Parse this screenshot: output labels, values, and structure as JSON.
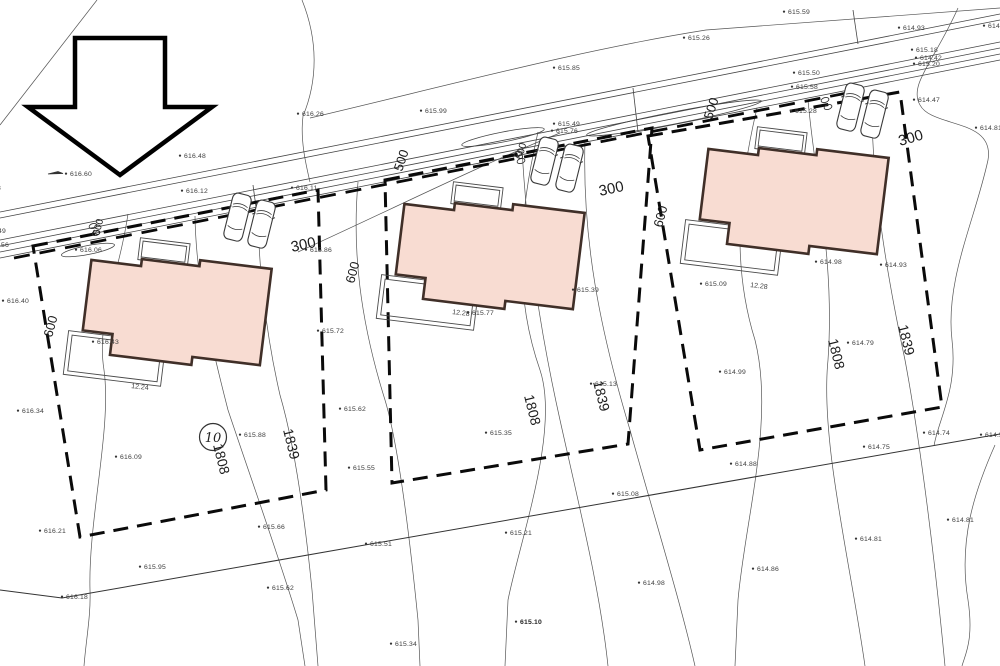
{
  "drawing": {
    "kind": "cadastral-site-plan",
    "plot_number_badge": "10",
    "colors": {
      "house_fill": "#f8dcd2",
      "house_stroke": "#402f28",
      "thin_line": "#4a4a4a",
      "boundary_dash": "#0a0a0a",
      "label_text": "#3d3d3d"
    },
    "elevation_points": [
      {
        "x": 70,
        "y": 176,
        "label": "616.60",
        "arrow": true
      },
      {
        "x": 184,
        "y": 158,
        "label": "616.48"
      },
      {
        "x": -21,
        "y": 190,
        "label": "616.38"
      },
      {
        "x": -16,
        "y": 233,
        "label": "616.49"
      },
      {
        "x": -13,
        "y": 247,
        "label": "616.56"
      },
      {
        "x": 7,
        "y": 303,
        "label": "616.40"
      },
      {
        "x": 22,
        "y": 413,
        "label": "616.34"
      },
      {
        "x": 44,
        "y": 533,
        "label": "616.21"
      },
      {
        "x": 120,
        "y": 459,
        "label": "616.09"
      },
      {
        "x": 80,
        "y": 252,
        "label": "616.06"
      },
      {
        "x": 97,
        "y": 344,
        "label": "616.43"
      },
      {
        "x": 244,
        "y": 437,
        "label": "615.88"
      },
      {
        "x": 144,
        "y": 569,
        "label": "615.95"
      },
      {
        "x": 66,
        "y": 599,
        "label": "616.18"
      },
      {
        "x": 263,
        "y": 529,
        "label": "615.66"
      },
      {
        "x": 272,
        "y": 590,
        "label": "615.62"
      },
      {
        "x": 395,
        "y": 646,
        "label": "615.34"
      },
      {
        "x": 520,
        "y": 624,
        "label": "615.10",
        "bold": true
      },
      {
        "x": 643,
        "y": 585,
        "label": "614.98"
      },
      {
        "x": 344,
        "y": 411,
        "label": "615.62"
      },
      {
        "x": 353,
        "y": 470,
        "label": "615.55"
      },
      {
        "x": 370,
        "y": 546,
        "label": "615.51"
      },
      {
        "x": 490,
        "y": 435,
        "label": "615.35"
      },
      {
        "x": 595,
        "y": 386,
        "label": "615.13"
      },
      {
        "x": 617,
        "y": 496,
        "label": "615.08"
      },
      {
        "x": 510,
        "y": 535,
        "label": "615.21"
      },
      {
        "x": 425,
        "y": 113,
        "label": "615.99"
      },
      {
        "x": 558,
        "y": 126,
        "label": "615.49"
      },
      {
        "x": 556,
        "y": 133,
        "label": "615.76"
      },
      {
        "x": 558,
        "y": 70,
        "label": "615.85"
      },
      {
        "x": 302,
        "y": 116,
        "label": "616.26"
      },
      {
        "x": 688,
        "y": 40,
        "label": "615.26"
      },
      {
        "x": 788,
        "y": 14,
        "label": "615.59"
      },
      {
        "x": 916,
        "y": 52,
        "label": "615.18"
      },
      {
        "x": 920,
        "y": 60,
        "label": "614.42"
      },
      {
        "x": 918,
        "y": 66,
        "label": "615.20"
      },
      {
        "x": 903,
        "y": 30,
        "label": "614.93"
      },
      {
        "x": 988,
        "y": 28,
        "label": "614.4"
      },
      {
        "x": 918,
        "y": 102,
        "label": "614.47"
      },
      {
        "x": 980,
        "y": 130,
        "label": "614.81"
      },
      {
        "x": 885,
        "y": 267,
        "label": "614.93"
      },
      {
        "x": 820,
        "y": 264,
        "label": "614.98"
      },
      {
        "x": 705,
        "y": 286,
        "label": "615.09"
      },
      {
        "x": 724,
        "y": 374,
        "label": "614.99"
      },
      {
        "x": 852,
        "y": 345,
        "label": "614.79"
      },
      {
        "x": 928,
        "y": 435,
        "label": "614.74"
      },
      {
        "x": 868,
        "y": 449,
        "label": "614.75"
      },
      {
        "x": 735,
        "y": 466,
        "label": "614.88"
      },
      {
        "x": 860,
        "y": 541,
        "label": "614.81"
      },
      {
        "x": 952,
        "y": 522,
        "label": "614.81"
      },
      {
        "x": 757,
        "y": 571,
        "label": "614.86"
      },
      {
        "x": 985,
        "y": 437,
        "label": "614.5"
      },
      {
        "x": 310,
        "y": 252,
        "label": "615.86"
      },
      {
        "x": 322,
        "y": 333,
        "label": "615.72"
      },
      {
        "x": 472,
        "y": 315,
        "label": "615.77"
      },
      {
        "x": 577,
        "y": 292,
        "label": "615.39"
      },
      {
        "x": 796,
        "y": 89,
        "label": "615.58"
      },
      {
        "x": 798,
        "y": 75,
        "label": "615.50"
      },
      {
        "x": 186,
        "y": 193,
        "label": "616.12"
      },
      {
        "x": 296,
        "y": 190,
        "label": "616.11"
      },
      {
        "x": 795,
        "y": 113,
        "label": "615.28"
      }
    ],
    "rotated_labels": [
      {
        "label": "300",
        "x": 292,
        "y": 252,
        "rot": -12,
        "size": 15
      },
      {
        "label": "300",
        "x": 600,
        "y": 196,
        "rot": -12,
        "size": 15
      },
      {
        "label": "300",
        "x": 900,
        "y": 146,
        "rot": -16,
        "size": 15
      },
      {
        "label": "600",
        "x": 52,
        "y": 338,
        "rot": -75,
        "size": 13
      },
      {
        "label": "600",
        "x": 354,
        "y": 284,
        "rot": -75,
        "size": 13
      },
      {
        "label": "600",
        "x": 662,
        "y": 228,
        "rot": -75,
        "size": 13
      },
      {
        "label": "600",
        "x": 522,
        "y": 160,
        "rot": -75,
        "size": 10
      },
      {
        "label": "600",
        "x": 99,
        "y": 236,
        "rot": -75,
        "size": 10
      },
      {
        "label": "500",
        "x": 402,
        "y": 172,
        "rot": -72,
        "size": 13
      },
      {
        "label": "500",
        "x": 712,
        "y": 120,
        "rot": -72,
        "size": 13
      },
      {
        "label": "1808",
        "x": 213,
        "y": 445,
        "rot": 76,
        "size": 14
      },
      {
        "label": "1839",
        "x": 283,
        "y": 430,
        "rot": 76,
        "size": 14
      },
      {
        "label": "1808",
        "x": 524,
        "y": 396,
        "rot": 76,
        "size": 14
      },
      {
        "label": "1839",
        "x": 593,
        "y": 382,
        "rot": 76,
        "size": 14
      },
      {
        "label": "1808",
        "x": 828,
        "y": 340,
        "rot": 76,
        "size": 14
      },
      {
        "label": "1839",
        "x": 898,
        "y": 326,
        "rot": 76,
        "size": 14
      }
    ],
    "dimension_labels": [
      {
        "label": "12.24",
        "x": 131,
        "y": 388,
        "rot": 7
      },
      {
        "label": "12.28",
        "x": 452,
        "y": 314,
        "rot": 7
      },
      {
        "label": "12.28",
        "x": 750,
        "y": 287,
        "rot": 7
      }
    ],
    "houses": [
      {
        "x": 93,
        "y": 247
      },
      {
        "x": 406,
        "y": 191
      },
      {
        "x": 710,
        "y": 136
      }
    ],
    "cars": [
      {
        "x": 234,
        "y": 192
      },
      {
        "x": 258,
        "y": 199
      },
      {
        "x": 541,
        "y": 136
      },
      {
        "x": 566,
        "y": 143
      },
      {
        "x": 847,
        "y": 82
      },
      {
        "x": 871,
        "y": 89
      }
    ],
    "drains": [
      {
        "x": 93,
        "y": 226
      },
      {
        "x": 518,
        "y": 154
      },
      {
        "x": 825,
        "y": 100
      }
    ]
  }
}
